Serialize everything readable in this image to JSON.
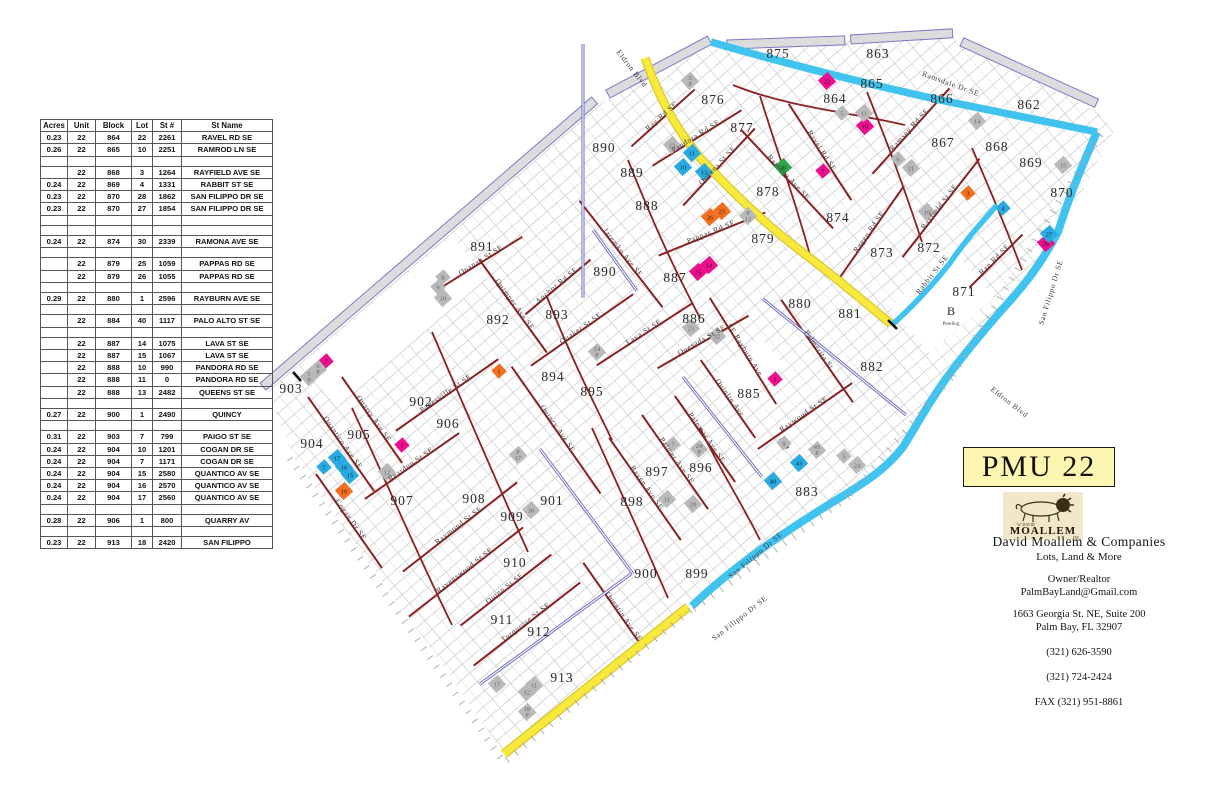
{
  "table": {
    "headers": [
      "Acres",
      "Unit",
      "Block",
      "Lot",
      "St #",
      "St Name"
    ],
    "rows": [
      [
        "0.23",
        "22",
        "864",
        "22",
        "2261",
        "RAVEL RD SE"
      ],
      [
        "0.26",
        "22",
        "865",
        "10",
        "2251",
        "RAMROD LN SE"
      ],
      [],
      [
        "",
        "22",
        "868",
        "3",
        "1264",
        "RAYFIELD AVE SE"
      ],
      [
        "0.24",
        "22",
        "869",
        "4",
        "1331",
        "RABBIT ST SE"
      ],
      [
        "0.23",
        "22",
        "870",
        "28",
        "1862",
        "SAN FILIPPO DR SE"
      ],
      [
        "0.23",
        "22",
        "870",
        "27",
        "1854",
        "SAN FILIPPO DR SE"
      ],
      [],
      [],
      [
        "0.24",
        "22",
        "874",
        "30",
        "2339",
        "RAMONA AVE SE"
      ],
      [],
      [
        "",
        "22",
        "879",
        "25",
        "1059",
        "PAPPAS RD SE"
      ],
      [
        "",
        "22",
        "879",
        "26",
        "1055",
        "PAPPAS RD SE"
      ],
      [],
      [
        "0.29",
        "22",
        "880",
        "1",
        "2596",
        "RAYBURN AVE SE"
      ],
      [],
      [
        "",
        "22",
        "884",
        "40",
        "1117",
        "PALO ALTO ST SE"
      ],
      [],
      [
        "",
        "22",
        "887",
        "14",
        "1075",
        "LAVA ST SE"
      ],
      [
        "",
        "22",
        "887",
        "15",
        "1067",
        "LAVA ST SE"
      ],
      [
        "",
        "22",
        "888",
        "10",
        "990",
        "PANDORA RD SE"
      ],
      [
        "",
        "22",
        "888",
        "11",
        "0",
        "PANDORA RD SE"
      ],
      [
        "",
        "22",
        "888",
        "13",
        "2482",
        "QUEENS ST SE"
      ],
      [],
      [
        "0.27",
        "22",
        "900",
        "1",
        "2490",
        "QUINCY"
      ],
      [],
      [
        "0.31",
        "22",
        "903",
        "7",
        "799",
        "PAIGO ST SE"
      ],
      [
        "0.24",
        "22",
        "904",
        "10",
        "1201",
        "COGAN DR SE"
      ],
      [
        "0.24",
        "22",
        "904",
        "7",
        "1171",
        "COGAN DR SE"
      ],
      [
        "0.24",
        "22",
        "904",
        "15",
        "2580",
        "QUANTICO AV SE"
      ],
      [
        "0.24",
        "22",
        "904",
        "16",
        "2570",
        "QUANTICO AV SE"
      ],
      [
        "0.24",
        "22",
        "904",
        "17",
        "2560",
        "QUANTICO AV SE"
      ],
      [],
      [
        "0.28",
        "22",
        "906",
        "1",
        "800",
        "QUARRY AV"
      ],
      [],
      [
        "0.23",
        "22",
        "913",
        "18",
        "2420",
        "SAN FILIPPO"
      ]
    ]
  },
  "title_box": {
    "label": "PMU 22"
  },
  "logo": {
    "top": "W. DAVID",
    "name": "MOALLEM",
    "sub": "INC"
  },
  "contact": {
    "company": "David Moallem & Companies",
    "tagline": "Lots, Land & More",
    "role": "Owner/Realtor",
    "email": "PalmBayLand@Gmail.com",
    "address1": "1663 Georgia St. NE, Suite 200",
    "address2": "Palm Bay, FL   32907",
    "phone1": "(321) 626-3590",
    "phone2": "(321) 724-2424",
    "fax": "FAX (321) 951-8861"
  },
  "map": {
    "colors": {
      "magenta": "#ec1090",
      "orange": "#f26f21",
      "blue": "#29abe2",
      "green": "#2fa849",
      "gray": "#b9b9b9",
      "road_yellow": "#f8e93c",
      "road_cyan": "#41c3ef",
      "road_red": "#8b2121"
    },
    "annotations": [
      {
        "text": "B",
        "sub": "Pending",
        "x": 951,
        "y": 315
      }
    ],
    "blocks": [
      {
        "id": "875",
        "x": 778,
        "y": 53
      },
      {
        "id": "863",
        "x": 878,
        "y": 53
      },
      {
        "id": "862",
        "x": 1029,
        "y": 104
      },
      {
        "id": "876",
        "x": 713,
        "y": 99
      },
      {
        "id": "864",
        "x": 835,
        "y": 98
      },
      {
        "id": "865",
        "x": 872,
        "y": 83
      },
      {
        "id": "866",
        "x": 942,
        "y": 98
      },
      {
        "id": "877",
        "x": 742,
        "y": 127
      },
      {
        "id": "867",
        "x": 943,
        "y": 142
      },
      {
        "id": "868",
        "x": 997,
        "y": 146
      },
      {
        "id": "869",
        "x": 1031,
        "y": 162
      },
      {
        "id": "870",
        "x": 1062,
        "y": 192
      },
      {
        "id": "890",
        "x": 604,
        "y": 147
      },
      {
        "id": "889",
        "x": 632,
        "y": 172
      },
      {
        "id": "888",
        "x": 647,
        "y": 205
      },
      {
        "id": "878",
        "x": 768,
        "y": 191
      },
      {
        "id": "874",
        "x": 838,
        "y": 217
      },
      {
        "id": "879",
        "x": 763,
        "y": 238
      },
      {
        "id": "873",
        "x": 882,
        "y": 252
      },
      {
        "id": "872",
        "x": 929,
        "y": 247
      },
      {
        "id": "871",
        "x": 964,
        "y": 291
      },
      {
        "id": "880",
        "x": 800,
        "y": 303
      },
      {
        "id": "881",
        "x": 850,
        "y": 313
      },
      {
        "id": "882",
        "x": 872,
        "y": 366
      },
      {
        "id": "891",
        "x": 482,
        "y": 246
      },
      {
        "id": "892",
        "x": 498,
        "y": 319
      },
      {
        "id": "893",
        "x": 557,
        "y": 314
      },
      {
        "id": "890",
        "x": 605,
        "y": 271
      },
      {
        "id": "887",
        "x": 675,
        "y": 277
      },
      {
        "id": "894",
        "x": 553,
        "y": 376
      },
      {
        "id": "895",
        "x": 592,
        "y": 391
      },
      {
        "id": "886",
        "x": 694,
        "y": 318
      },
      {
        "id": "885",
        "x": 749,
        "y": 393
      },
      {
        "id": "902",
        "x": 421,
        "y": 401
      },
      {
        "id": "903",
        "x": 291,
        "y": 388
      },
      {
        "id": "905",
        "x": 359,
        "y": 434
      },
      {
        "id": "904",
        "x": 312,
        "y": 443
      },
      {
        "id": "906",
        "x": 448,
        "y": 423
      },
      {
        "id": "907",
        "x": 402,
        "y": 500
      },
      {
        "id": "908",
        "x": 474,
        "y": 498
      },
      {
        "id": "909",
        "x": 512,
        "y": 516
      },
      {
        "id": "901",
        "x": 552,
        "y": 500
      },
      {
        "id": "898",
        "x": 632,
        "y": 501
      },
      {
        "id": "897",
        "x": 657,
        "y": 471
      },
      {
        "id": "896",
        "x": 701,
        "y": 467
      },
      {
        "id": "883",
        "x": 807,
        "y": 491
      },
      {
        "id": "910",
        "x": 515,
        "y": 562
      },
      {
        "id": "911",
        "x": 502,
        "y": 619
      },
      {
        "id": "912",
        "x": 539,
        "y": 631
      },
      {
        "id": "913",
        "x": 562,
        "y": 677
      },
      {
        "id": "900",
        "x": 646,
        "y": 573
      },
      {
        "id": "899",
        "x": 697,
        "y": 573
      }
    ],
    "streets": [
      {
        "name": "Ray Rd SE",
        "x": 663,
        "y": 118,
        "rot": -42,
        "len": 85
      },
      {
        "name": "Pandora Rd SE",
        "x": 697,
        "y": 138,
        "rot": -32,
        "len": 105
      },
      {
        "name": "Queens St SE",
        "x": 719,
        "y": 167,
        "rot": -47,
        "len": 105
      },
      {
        "name": "Ramsey Rd SE",
        "x": 911,
        "y": 131,
        "rot": -48,
        "len": 115
      },
      {
        "name": "Rayfield St SE",
        "x": 941,
        "y": 208,
        "rot": -52,
        "len": 125
      },
      {
        "name": "Ragen Rd SE",
        "x": 871,
        "y": 233,
        "rot": -55,
        "len": 115
      },
      {
        "name": "Ran Rd SE",
        "x": 996,
        "y": 261,
        "rot": -45,
        "len": 75
      },
      {
        "name": "Pappas Rd SE",
        "x": 712,
        "y": 234,
        "rot": -22,
        "len": 115
      },
      {
        "name": "Quanah St SE",
        "x": 482,
        "y": 262,
        "rot": -32,
        "len": 95
      },
      {
        "name": "Anchor Rd SE",
        "x": 558,
        "y": 287,
        "rot": -40,
        "len": 85
      },
      {
        "name": "Quaker St SE",
        "x": 582,
        "y": 330,
        "rot": -35,
        "len": 125
      },
      {
        "name": "Lava St SE",
        "x": 645,
        "y": 334,
        "rot": -33,
        "len": 115
      },
      {
        "name": "Quesada St SE",
        "x": 703,
        "y": 342,
        "rot": -30,
        "len": 105
      },
      {
        "name": "Raywood St SE",
        "x": 805,
        "y": 416,
        "rot": -35,
        "len": 115
      },
      {
        "name": "Panesville St SE",
        "x": 447,
        "y": 395,
        "rot": -35,
        "len": 125
      },
      {
        "name": "Reardon St SE",
        "x": 412,
        "y": 466,
        "rot": -35,
        "len": 115
      },
      {
        "name": "Raymond St SE",
        "x": 460,
        "y": 527,
        "rot": -38,
        "len": 145
      },
      {
        "name": "Ravenswood St SE",
        "x": 466,
        "y": 572,
        "rot": -38,
        "len": 145
      },
      {
        "name": "Quinn St SE",
        "x": 506,
        "y": 590,
        "rot": -38,
        "len": 115
      },
      {
        "name": "Turquoise St SE",
        "x": 527,
        "y": 624,
        "rot": -38,
        "len": 135
      },
      {
        "name": "Ramona Ave SE",
        "x": 787,
        "y": 179,
        "rot": 47,
        "len": 135
      },
      {
        "name": "Ravel Rd SE",
        "x": 820,
        "y": 152,
        "rot": 57,
        "len": 115
      },
      {
        "name": "Jaremko Ave SE",
        "x": 621,
        "y": 254,
        "rot": 52,
        "len": 135
      },
      {
        "name": "Quimper Ave SE",
        "x": 513,
        "y": 306,
        "rot": 54,
        "len": 115
      },
      {
        "name": "SE Rayburn Ave",
        "x": 743,
        "y": 351,
        "rot": 58,
        "len": 125
      },
      {
        "name": "Palmerita St",
        "x": 817,
        "y": 351,
        "rot": 55,
        "len": 125
      },
      {
        "name": "Quinlin Ave",
        "x": 728,
        "y": 399,
        "rot": 55,
        "len": 95
      },
      {
        "name": "Palomar Ave SE",
        "x": 705,
        "y": 439,
        "rot": 55,
        "len": 105
      },
      {
        "name": "Palmer Ave SE",
        "x": 675,
        "y": 462,
        "rot": 55,
        "len": 115
      },
      {
        "name": "Raven Ave SE",
        "x": 645,
        "y": 489,
        "rot": 55,
        "len": 125
      },
      {
        "name": "Quincy Ave SE",
        "x": 556,
        "y": 430,
        "rot": 55,
        "len": 155
      },
      {
        "name": "Quarry Ave SE",
        "x": 372,
        "y": 420,
        "rot": 55,
        "len": 105
      },
      {
        "name": "Quantico Ave SE",
        "x": 341,
        "y": 444,
        "rot": 55,
        "len": 115
      },
      {
        "name": "Cogan Dr SE",
        "x": 349,
        "y": 521,
        "rot": 55,
        "len": 115
      },
      {
        "name": "Quentin Ave SE",
        "x": 622,
        "y": 618,
        "rot": 55,
        "len": 135
      },
      {
        "name": "Eldron Blvd",
        "x": 630,
        "y": 70,
        "rot": 52,
        "len": 0,
        "size": 9.5
      },
      {
        "name": "Eldron Blvd",
        "x": 1008,
        "y": 404,
        "rot": 38,
        "len": 0,
        "size": 10
      },
      {
        "name": "Ramsdale Dr SE",
        "x": 950,
        "y": 86,
        "rot": 20,
        "len": 0,
        "size": 9
      },
      {
        "name": "San Filippo Dr SE",
        "x": 1053,
        "y": 293,
        "rot": -73,
        "len": 0,
        "size": 9
      },
      {
        "name": "San Filippo Dr SE",
        "x": 757,
        "y": 557,
        "rot": -40,
        "len": 0,
        "size": 8,
        "fill": "#5b6770"
      },
      {
        "name": "San Filippo Dr SE",
        "x": 741,
        "y": 620,
        "rot": -38,
        "len": 0,
        "size": 11
      },
      {
        "name": "Rabbit St SE",
        "x": 934,
        "y": 276,
        "rot": -52,
        "len": 0,
        "size": 8
      }
    ],
    "markers": [
      {
        "c": "magenta",
        "l": "22",
        "x": 827,
        "y": 81
      },
      {
        "c": "magenta",
        "l": "10",
        "x": 865,
        "y": 126
      },
      {
        "c": "magenta",
        "l": "7",
        "x": 823,
        "y": 171
      },
      {
        "c": "magenta",
        "l": "14",
        "x": 709,
        "y": 265
      },
      {
        "c": "magenta",
        "l": "15",
        "x": 698,
        "y": 272
      },
      {
        "c": "magenta",
        "l": "28",
        "x": 1046,
        "y": 243
      },
      {
        "c": "magenta",
        "l": "1",
        "x": 775,
        "y": 379
      },
      {
        "c": "magenta",
        "l": "1",
        "x": 402,
        "y": 445
      },
      {
        "c": "magenta",
        "l": "7",
        "x": 326,
        "y": 361
      },
      {
        "c": "orange",
        "l": "26",
        "x": 710,
        "y": 217
      },
      {
        "c": "orange",
        "l": "25",
        "x": 722,
        "y": 211
      },
      {
        "c": "orange",
        "l": "3",
        "x": 968,
        "y": 193
      },
      {
        "c": "orange",
        "l": "1",
        "x": 499,
        "y": 371
      },
      {
        "c": "orange",
        "l": "10",
        "x": 344,
        "y": 491
      },
      {
        "c": "blue",
        "l": "11",
        "x": 692,
        "y": 153
      },
      {
        "c": "blue",
        "l": "10",
        "x": 683,
        "y": 167
      },
      {
        "c": "blue",
        "l": "13",
        "x": 704,
        "y": 172
      },
      {
        "c": "blue",
        "l": "4",
        "x": 1003,
        "y": 208
      },
      {
        "c": "blue",
        "l": "27",
        "x": 1049,
        "y": 234
      },
      {
        "c": "blue",
        "l": "17",
        "x": 337,
        "y": 458
      },
      {
        "c": "blue",
        "l": "16",
        "x": 344,
        "y": 467
      },
      {
        "c": "blue",
        "l": "15",
        "x": 350,
        "y": 475
      },
      {
        "c": "blue",
        "l": "7",
        "x": 324,
        "y": 467
      },
      {
        "c": "blue",
        "l": "43",
        "x": 799,
        "y": 463
      },
      {
        "c": "blue",
        "l": "40",
        "x": 773,
        "y": 481
      },
      {
        "c": "green",
        "l": "30",
        "x": 783,
        "y": 167
      },
      {
        "c": "gray",
        "l": "3",
        "l2": "P",
        "x": 690,
        "y": 81
      },
      {
        "c": "gray",
        "l": "5",
        "x": 842,
        "y": 113
      },
      {
        "c": "gray",
        "l": "11",
        "x": 864,
        "y": 113
      },
      {
        "c": "gray",
        "l": "13",
        "x": 672,
        "y": 145
      },
      {
        "c": "gray",
        "l": "14",
        "x": 977,
        "y": 121
      },
      {
        "c": "gray",
        "l": "15",
        "x": 1063,
        "y": 165
      },
      {
        "c": "gray",
        "l": "6",
        "x": 898,
        "y": 159
      },
      {
        "c": "gray",
        "l": "21",
        "x": 911,
        "y": 168
      },
      {
        "c": "gray",
        "l": "19",
        "x": 927,
        "y": 212
      },
      {
        "c": "gray",
        "l": "P",
        "l2": "12",
        "x": 748,
        "y": 216
      },
      {
        "c": "gray",
        "l": "8",
        "x": 443,
        "y": 277
      },
      {
        "c": "gray",
        "l": "9",
        "x": 438,
        "y": 287
      },
      {
        "c": "gray",
        "l": "10",
        "x": 443,
        "y": 298
      },
      {
        "c": "gray",
        "l": "24",
        "l2": "P",
        "x": 597,
        "y": 352
      },
      {
        "c": "gray",
        "l": "23",
        "x": 691,
        "y": 328
      },
      {
        "c": "gray",
        "l": "32",
        "x": 717,
        "y": 336
      },
      {
        "c": "gray",
        "l": "7",
        "x": 673,
        "y": 444
      },
      {
        "c": "gray",
        "l": "24",
        "l2": "P",
        "x": 699,
        "y": 449
      },
      {
        "c": "gray",
        "l": "45",
        "l2": "P",
        "x": 817,
        "y": 450
      },
      {
        "c": "gray",
        "l": "5",
        "x": 844,
        "y": 456
      },
      {
        "c": "gray",
        "l": "24",
        "x": 857,
        "y": 465
      },
      {
        "c": "gray",
        "l": "8",
        "x": 784,
        "y": 443
      },
      {
        "c": "gray",
        "l": "11",
        "x": 667,
        "y": 499
      },
      {
        "c": "gray",
        "l": "20",
        "x": 693,
        "y": 504
      },
      {
        "c": "gray",
        "l": "12",
        "x": 387,
        "y": 472
      },
      {
        "c": "gray",
        "l": "30",
        "x": 531,
        "y": 510
      },
      {
        "c": "gray",
        "l": "P",
        "l2": "17",
        "x": 518,
        "y": 455
      },
      {
        "c": "gray",
        "l": "17",
        "x": 497,
        "y": 684
      },
      {
        "c": "gray",
        "l": "11",
        "x": 534,
        "y": 685
      },
      {
        "c": "gray",
        "l": "12",
        "x": 527,
        "y": 692
      },
      {
        "c": "gray",
        "l": "18",
        "l2": "P",
        "x": 527,
        "y": 712
      },
      {
        "c": "gray",
        "l": "6",
        "l2": "P",
        "x": 318,
        "y": 369
      },
      {
        "c": "gray",
        "l": "5",
        "l2": "P",
        "x": 309,
        "y": 377
      }
    ]
  }
}
